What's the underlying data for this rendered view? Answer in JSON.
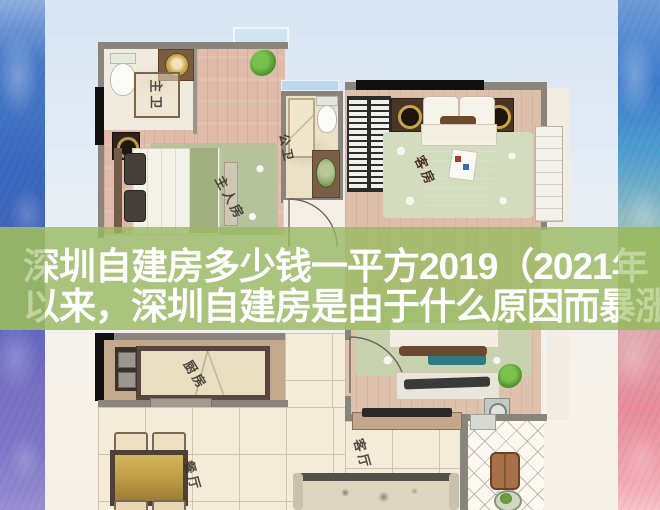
{
  "title": {
    "line1": "深圳自建房多少钱一平方2019（2021年",
    "line2": "以来，深圳自建房是由于什么原因而暴涨"
  },
  "overlay": {
    "band_color": "#99b962",
    "text_color": "#ffffff"
  },
  "watercolor": {
    "left_top": "#4a7cc9",
    "left_bottom": "#8277c8",
    "right_top": "#3f7ccc",
    "right_bottom": "#f2aab4"
  },
  "floorplan": {
    "rooms": [
      {
        "id": "master-bath",
        "label": "主卫"
      },
      {
        "id": "master-bedroom",
        "label": "主人房"
      },
      {
        "id": "public-bath",
        "label": "公卫"
      },
      {
        "id": "guest-room",
        "label": "客房"
      },
      {
        "id": "kitchen",
        "label": "厨房"
      },
      {
        "id": "dining",
        "label": "餐厅"
      },
      {
        "id": "living",
        "label": "客厅"
      }
    ]
  }
}
